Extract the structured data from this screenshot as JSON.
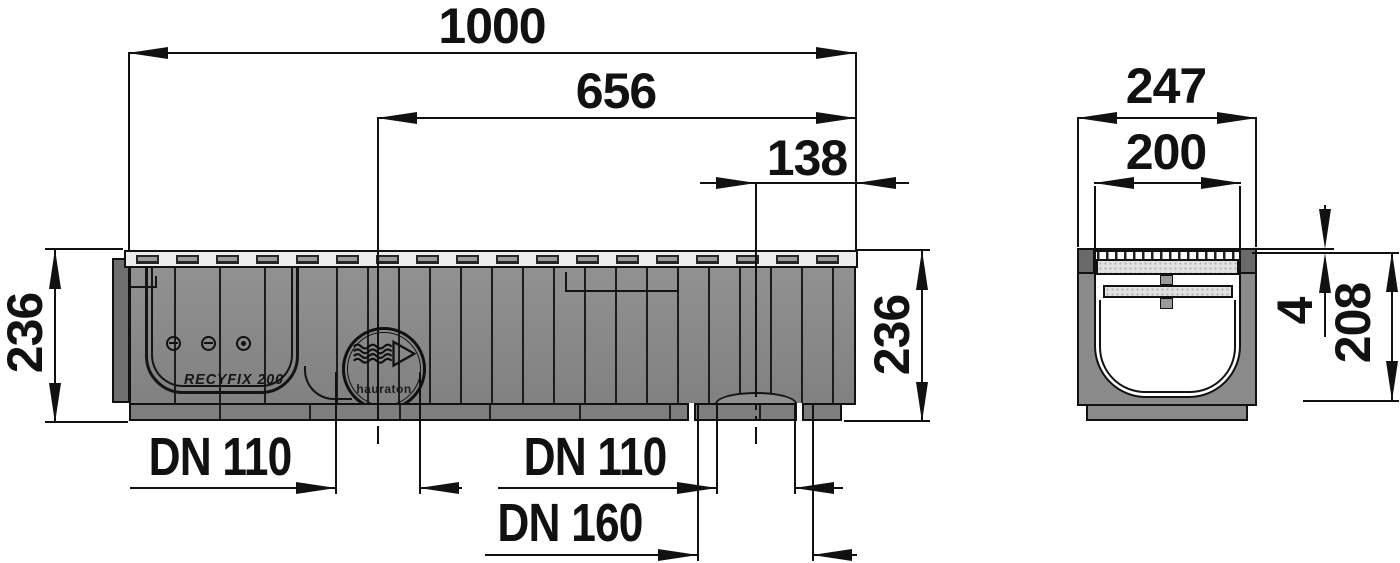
{
  "side_view": {
    "dim_total_length": "1000",
    "dim_left_outlet_to_end": "656",
    "dim_right_outlet_to_end": "138",
    "dim_height_left": "236",
    "dim_height_right": "236",
    "label_outlet_left": "DN 110",
    "label_outlet_bottom": "DN 110",
    "label_outlet_bottom_large": "DN 160",
    "product_text": "RECYFIX 200",
    "logo_text": "hauraton"
  },
  "cross_section": {
    "dim_overall_width": "247",
    "dim_clear_width": "200",
    "dim_grate_recess": "4",
    "dim_body_height": "208"
  },
  "colors": {
    "line": "#111111",
    "channel_body_gray": "#878787",
    "grate_gray": "#ececec",
    "background": "#ffffff"
  }
}
